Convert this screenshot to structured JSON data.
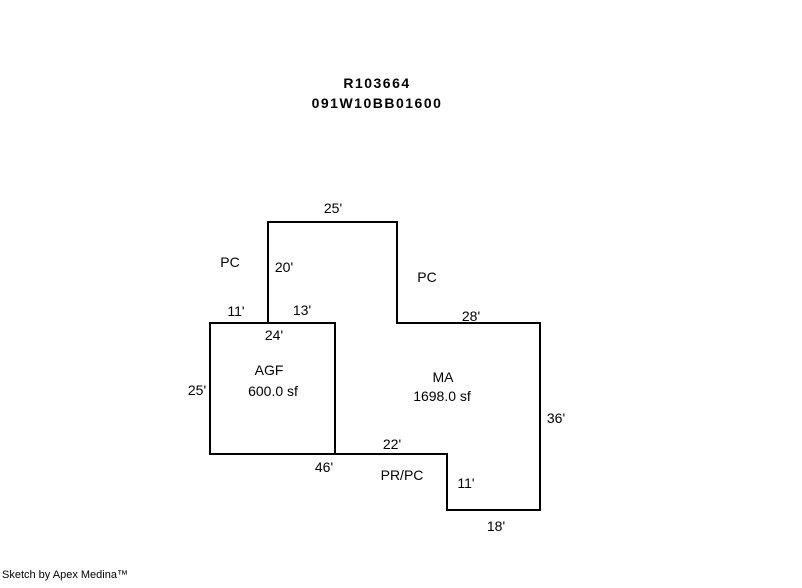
{
  "title": {
    "line1": "R103664",
    "line2": "091W10BB01600"
  },
  "sketch": {
    "colors": {
      "line": "#000000",
      "background": "#ffffff",
      "text": "#000000"
    },
    "areas": [
      {
        "code": "AGF",
        "area": "600.0 sf"
      },
      {
        "code": "MA",
        "area": "1698.0 sf"
      }
    ],
    "wall_labels": {
      "top_width": "25'",
      "upper_wall_height": "20'",
      "pc_left": "PC",
      "pc_right": "PC",
      "agf_top_left": "11'",
      "agf_top_right": "13'",
      "ma_top_width": "28'",
      "agf_top_inner": "24'",
      "agf_left_height": "25'",
      "ma_right_height": "36'",
      "ma_bottom_width": "22'",
      "pr_pc": "PR/PC",
      "bottom_width": "46'",
      "step_height": "11'",
      "bottom_right_width": "18'"
    }
  },
  "footer": {
    "credit": "Sketch by Apex Medina™"
  }
}
